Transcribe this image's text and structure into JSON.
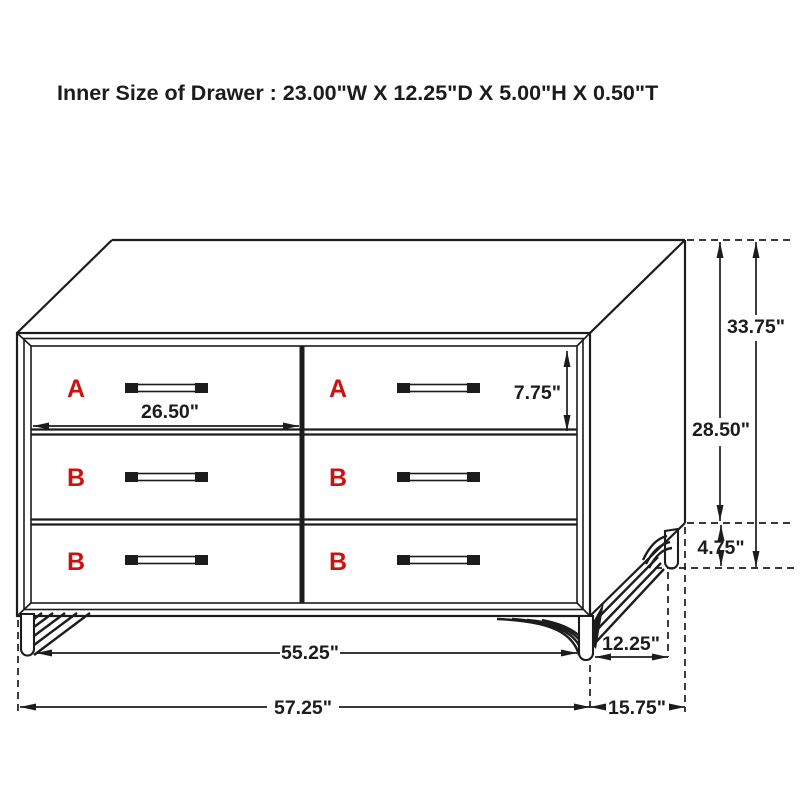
{
  "title": "Inner Size of Drawer : 23.00\"W X 12.25\"D X 5.00\"H X 0.50\"T",
  "diagram": {
    "drawer_labels": {
      "top_left": "A",
      "top_right": "A",
      "middle_left": "B",
      "middle_right": "B",
      "bottom_left": "B",
      "bottom_right": "B"
    },
    "dimensions": {
      "drawer_front_width": "26.50\"",
      "drawer_front_height": "7.75\"",
      "overall_height": "33.75\"",
      "case_height": "28.50\"",
      "leg_height": "4.75\"",
      "foot_span_width": "55.25\"",
      "foot_span_depth": "12.25\"",
      "overall_width": "57.25\"",
      "overall_depth": "15.75\""
    },
    "colors": {
      "line": "#1c1c1c",
      "drawer_letter_red": "#cc1111",
      "background": "#ffffff"
    }
  }
}
